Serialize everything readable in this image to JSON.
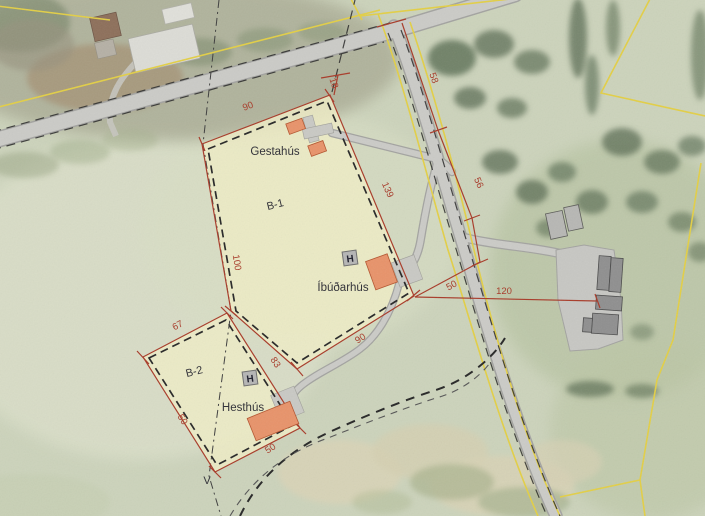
{
  "map": {
    "title": "Site development plan over aerial photo",
    "labels": {
      "b1": "B-1",
      "b2": "B-2",
      "guesthouse": "Gestahús",
      "residence": "Íbúðarhús",
      "stable": "Hesthús"
    },
    "markers": {
      "h1": "H",
      "h2": "H",
      "v": "V"
    },
    "dimensions": {
      "b1_top": "90",
      "b1_road_setback": "18",
      "b1_east": "139",
      "b1_west": "100",
      "b1_south": "90",
      "b2_north": "67",
      "b2_east": "83",
      "b2_west": "50",
      "b2_south": "50",
      "road_upper": "58",
      "road_lower": "56",
      "corner_to_road": "50",
      "corner_to_farm": "120"
    },
    "colors": {
      "parcel_fill": "#eeecc6",
      "dimension_red": "#a83a28",
      "cadastral_yellow": "#e3cf45",
      "building_orange": "#e8936a",
      "road_grey": "#cbcbc7"
    }
  }
}
